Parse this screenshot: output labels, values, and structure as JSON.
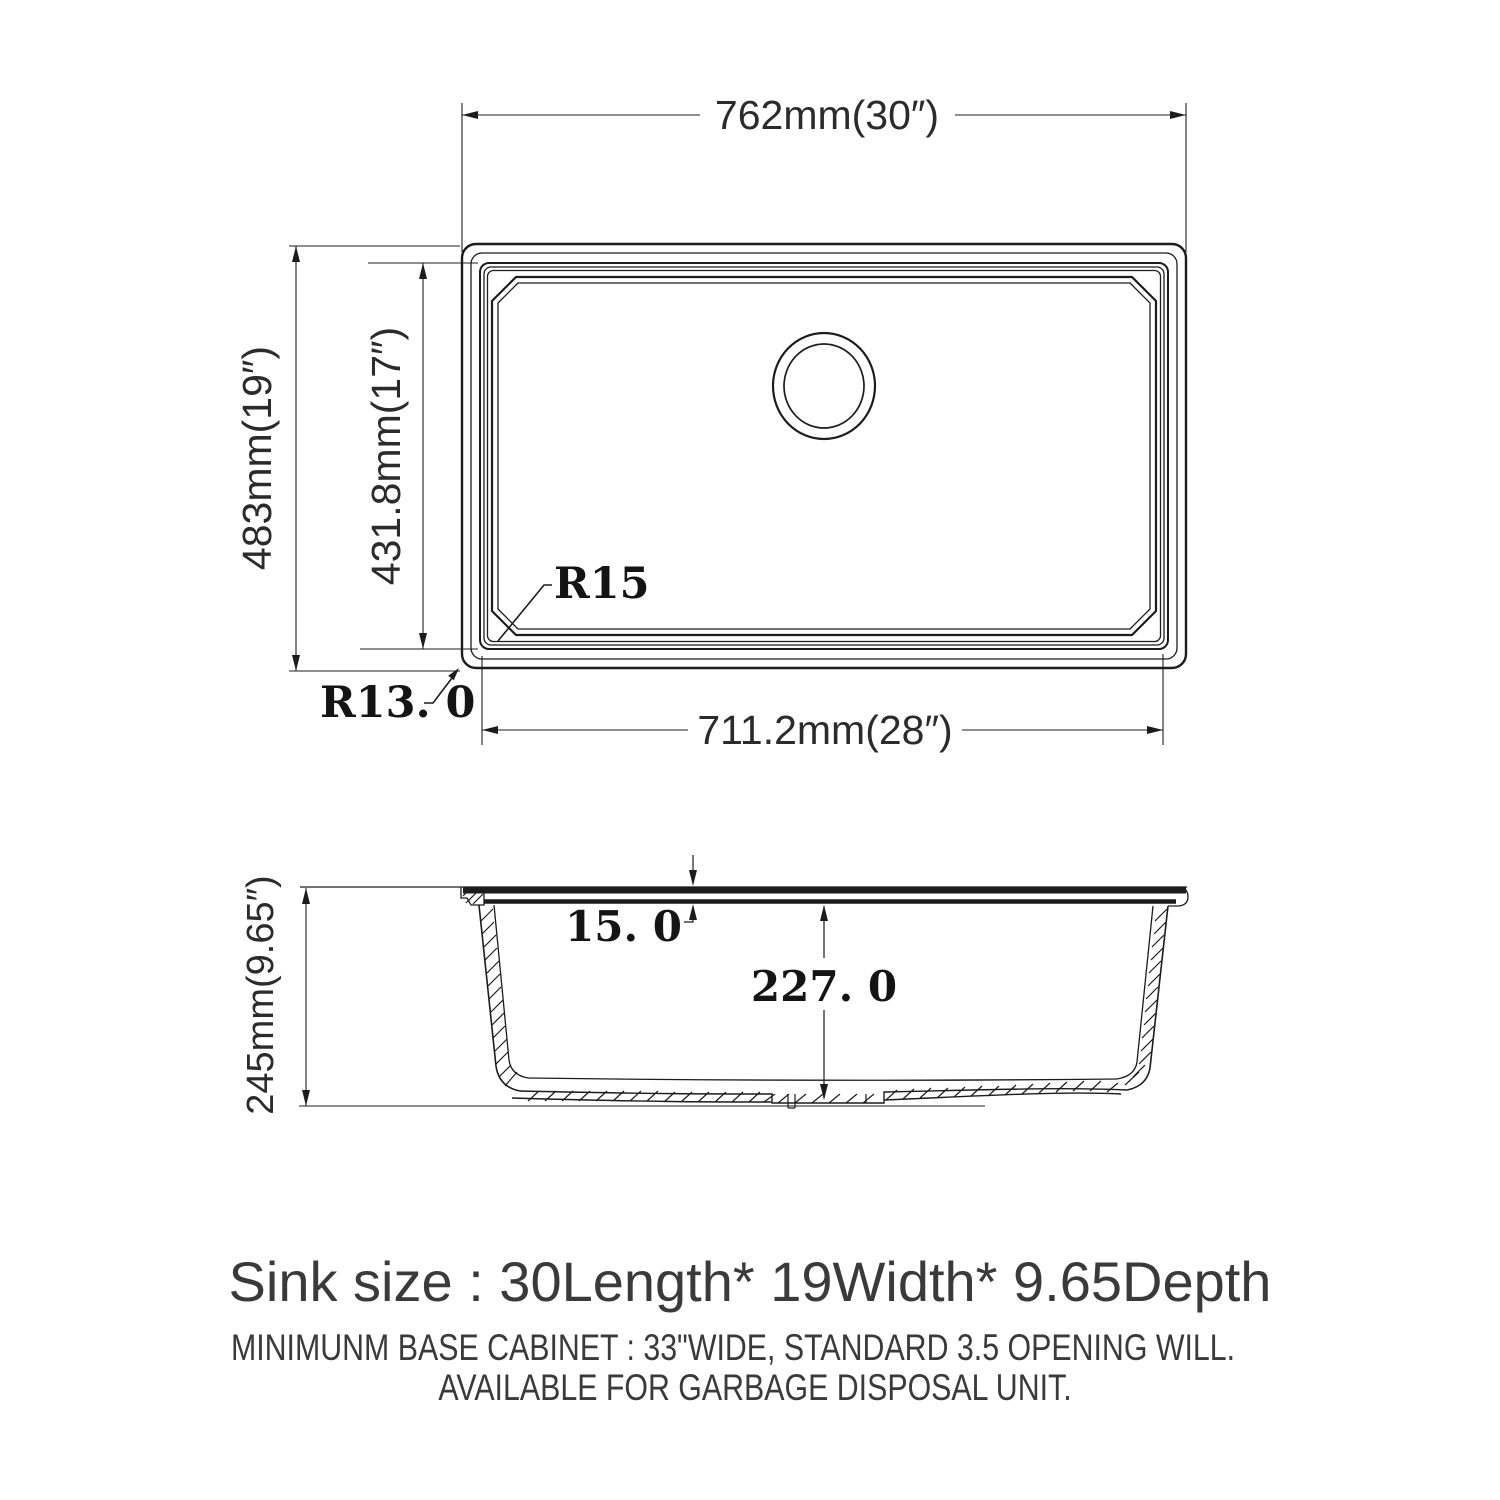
{
  "diagram": {
    "top_view": {
      "dim_overall_width": "762mm(30″)",
      "dim_overall_depth": "483mm(19″)",
      "dim_inner_depth": "431.8mm(17″)",
      "dim_inner_width": "711.2mm(28″)",
      "label_inner_corner_radius": "R15",
      "label_outer_corner_radius": "R13. 0"
    },
    "side_view": {
      "dim_overall_height": "245mm(9.65″)",
      "dim_rim_thickness": "15. 0",
      "dim_bowl_depth": "227. 0"
    },
    "caption": {
      "size_line": "Sink size :  30Length* 19Width* 9.65Depth",
      "note_line_1": "MINIMUNM BASE CABINET : 33\"WIDE,  STANDARD 3.5 OPENING WILL.",
      "note_line_2": "AVAILABLE FOR GARBAGE DISPOSAL UNIT."
    },
    "colors": {
      "line": "#1c1c1c",
      "caption_text": "#3a3a3a"
    }
  }
}
